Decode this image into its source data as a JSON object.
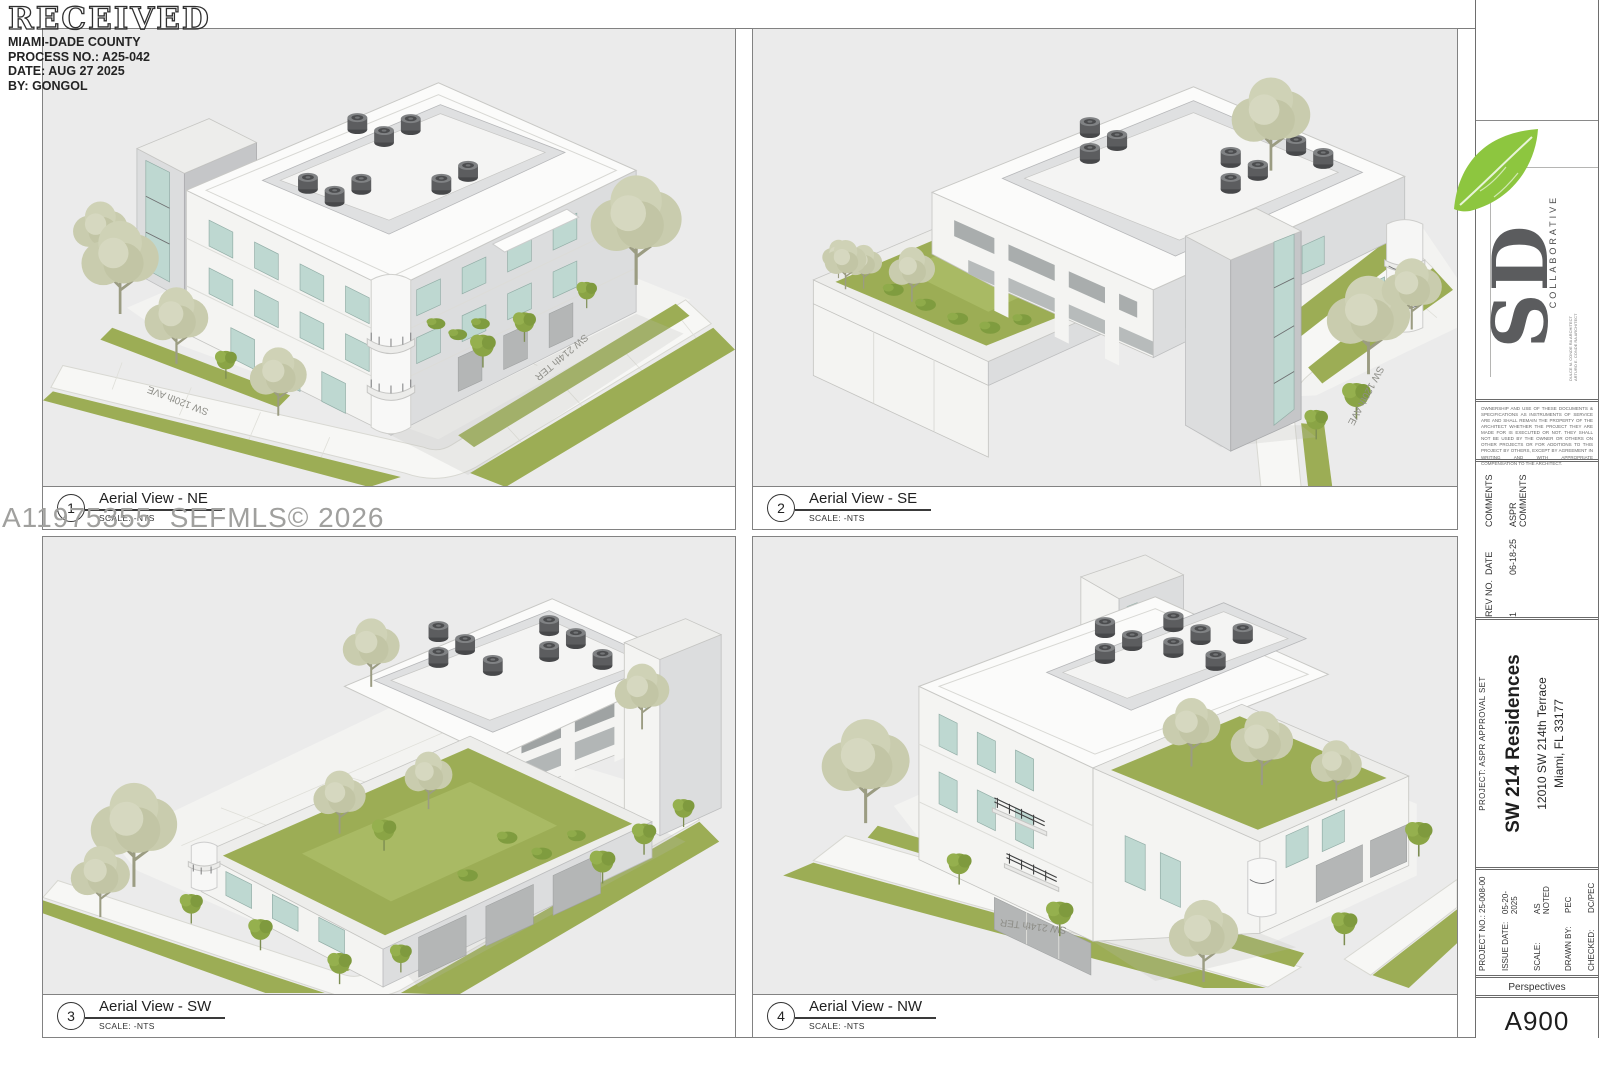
{
  "stamp": {
    "title": "RECEIVED",
    "agency": "MIAMI-DADE COUNTY",
    "process_no": "PROCESS NO.: A25-042",
    "date": "DATE: AUG 27 2025",
    "by": "BY: GONGOL"
  },
  "watermark": "A11975355  SEFMLS© 2026",
  "panels": [
    {
      "num": "1",
      "title": "Aerial View - NE",
      "scale_label": "SCALE: -NTS",
      "street_a": "SW 120th AVE",
      "street_b": "SW 214th TER"
    },
    {
      "num": "2",
      "title": "Aerial View - SE",
      "scale_label": "SCALE: -NTS",
      "street_a": "SW 120th AVE"
    },
    {
      "num": "3",
      "title": "Aerial View - SW",
      "scale_label": "SCALE: -NTS"
    },
    {
      "num": "4",
      "title": "Aerial View - NW",
      "scale_label": "SCALE: -NTS",
      "street_a": "SW 214th TER"
    }
  ],
  "titleblock": {
    "logo": {
      "sd": "SD",
      "collaborative": "COLLABORATIVE",
      "architect_line1": "DULCE M. CONDE RA ARCHITECT",
      "architect_line2": "ARTURO E. CONDE RA ARCHITECT"
    },
    "disclaimer": "OWNERSHIP AND USE OF THESE DOCUMENTS & SPECIFICATIONS AS INSTRUMENTS OF SERVICE ARE AND SHALL REMAIN THE PROPERTY OF THE ARCHITECT WHETHER THE PROJECT THEY ARE MADE FOR IS EXECUTED OR NOT. THEY SHALL NOT BE USED BY THE OWNER OR OTHERS ON OTHER PROJECTS OR FOR ADDITIONS TO THIS PROJECT BY OTHERS, EXCEPT BY AGREEMENT IN WRITING AND WITH APPROPRIATE COMPENSATION TO THE ARCHITECT.",
    "revision": {
      "rev_label": "REV NO.",
      "rev_value": "1",
      "date_label": "DATE",
      "date_value": "06-18-25",
      "comments_label": "COMMENTS",
      "comments_value": "ASPR COMMENTS"
    },
    "project": {
      "set_label": "PROJECT: ASPR APPROVAL SET",
      "name": "SW 214 Residences",
      "address1": "12010 SW 214th Terrace",
      "address2": "Miami, FL 33177"
    },
    "info": {
      "rows": [
        {
          "label": "PROJECT NO.:",
          "value": "25-008-00"
        },
        {
          "label": "ISSUE DATE:",
          "value": "05-20-2025"
        },
        {
          "label": "SCALE:",
          "value": "AS NOTED"
        },
        {
          "label": "DRAWN BY:",
          "value": "PEC"
        },
        {
          "label": "CHECKED:",
          "value": "DC/PEC"
        }
      ]
    },
    "sheet_title": "Perspectives",
    "sheet_number": "A900"
  },
  "colors": {
    "leaf_green": "#8dc63f",
    "grass_green": "#9cad55",
    "tree_sage": "#c9ccae",
    "window_teal": "#bed8d1",
    "viewport_gray": "#ebebeb"
  }
}
